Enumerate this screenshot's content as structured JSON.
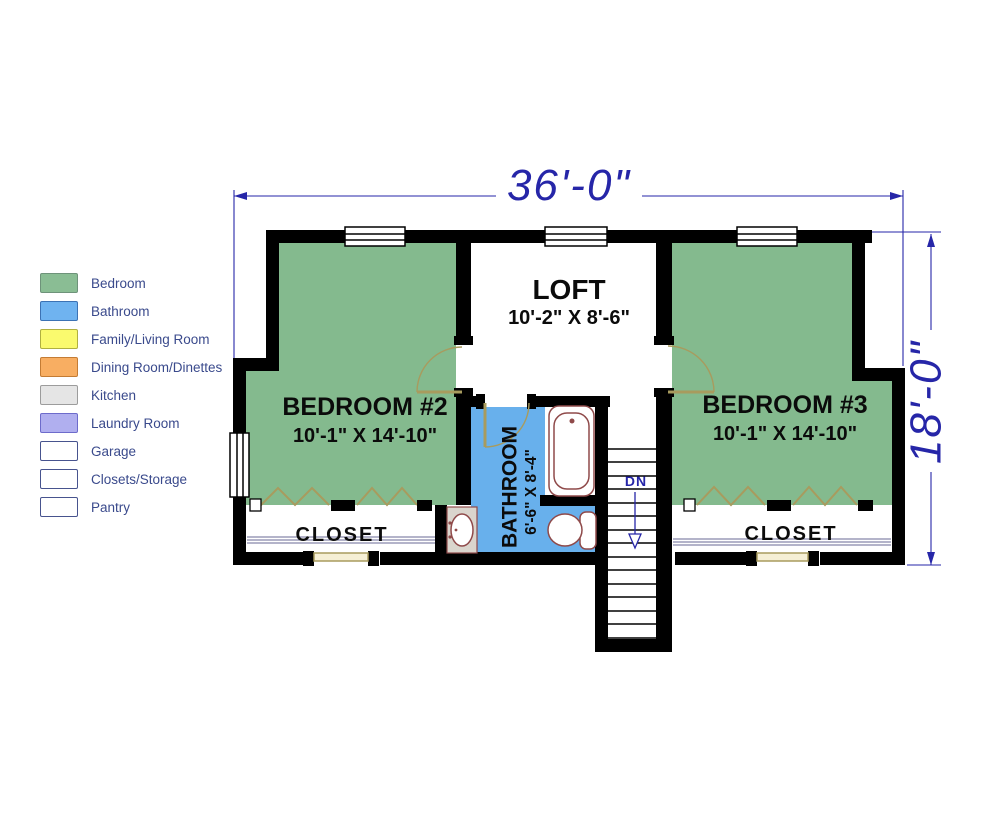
{
  "legend": {
    "text_color": "#3A4A8C",
    "items": [
      {
        "label": "Bedroom",
        "fill": "#8ABD94",
        "border": "#6E937A"
      },
      {
        "label": "Bathroom",
        "fill": "#6FB3F0",
        "border": "#3C72B4"
      },
      {
        "label": "Family/Living Room",
        "fill": "#FAFA6E",
        "border": "#B0B040"
      },
      {
        "label": "Dining Room/Dinettes",
        "fill": "#F8AE62",
        "border": "#C47C34"
      },
      {
        "label": "Kitchen",
        "fill": "#E5E5E5",
        "border": "#9C9C9C"
      },
      {
        "label": "Laundry Room",
        "fill": "#B0AFEF",
        "border": "#6D6BCB"
      },
      {
        "label": "Garage",
        "fill": "#FFFFFF",
        "border": "#47538E"
      },
      {
        "label": "Closets/Storage",
        "fill": "#FFFFFF",
        "border": "#47538E"
      },
      {
        "label": "Pantry",
        "fill": "#FFFFFF",
        "border": "#47538E"
      }
    ]
  },
  "plan": {
    "dimensions": {
      "width": "36'-0\"",
      "height": "18'-0\""
    },
    "rooms": {
      "bedroom2": {
        "name": "BEDROOM #2",
        "size": "10'-1\" X 14'-10\""
      },
      "bedroom3": {
        "name": "BEDROOM #3",
        "size": "10'-1\" X 14'-10\""
      },
      "loft": {
        "name": "LOFT",
        "size": "10'-2\" X 8'-6\""
      },
      "bathroom": {
        "name": "BATHROOM",
        "size": "6'-6\" X 8'-4\""
      },
      "closet_left": {
        "name": "CLOSET"
      },
      "closet_right": {
        "name": "CLOSET"
      },
      "stairs": {
        "label": "DN"
      }
    },
    "colors": {
      "bedroom_fill": "#84BA8E",
      "bathroom_fill": "#68B0EC",
      "wall": "#000000",
      "dimension": "#2626A8",
      "fixture": "#8F4A4A",
      "door": "#A89B5E",
      "window_tan": "#F5EFD5",
      "shelf": "#6A6A96",
      "vanity_fill": "#DAD5CD"
    }
  }
}
